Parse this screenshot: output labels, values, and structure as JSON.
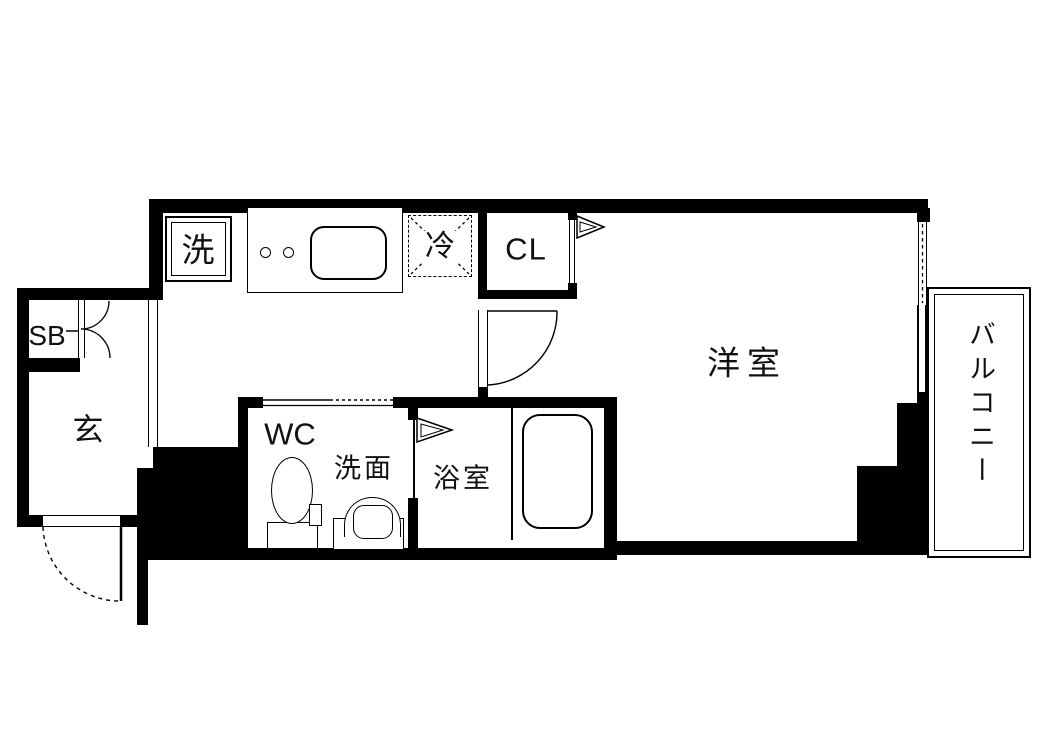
{
  "plan": {
    "type": "apartment-floor-plan",
    "colors": {
      "wall": "#000000",
      "floor": "#ffffff",
      "text": "#111111"
    },
    "rooms": {
      "washer": "洗",
      "fridge": "冷",
      "closet": "CL",
      "western_room": "洋室",
      "balcony": "バルコニー",
      "entrance": "玄",
      "shoe_box": "SB",
      "toilet": "WC",
      "washroom": "洗面",
      "bathroom": "浴室"
    }
  }
}
